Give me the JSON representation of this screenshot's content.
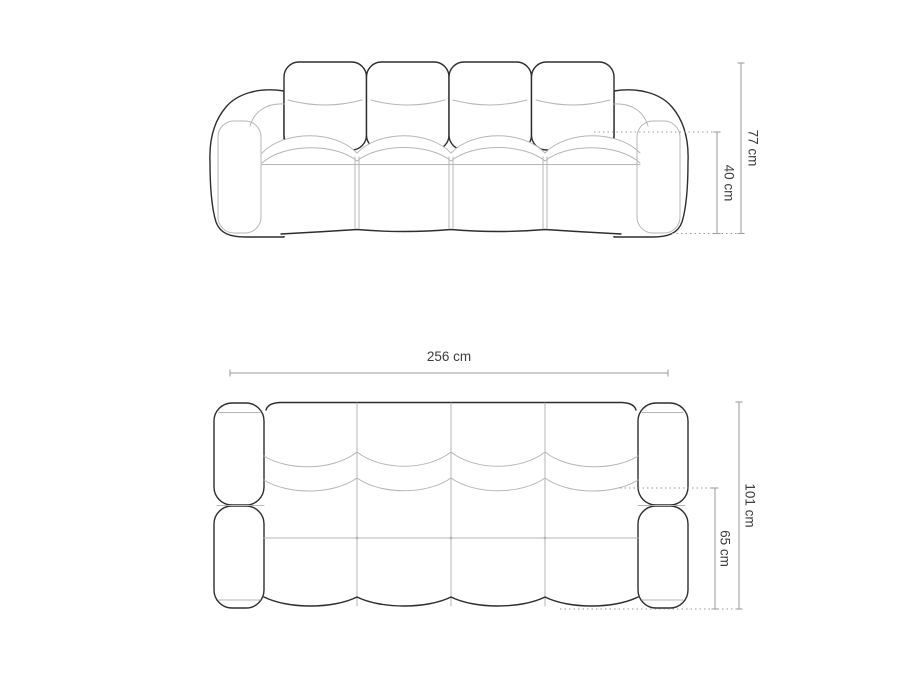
{
  "colors": {
    "background": "#ffffff",
    "outline": "#2e2e2e",
    "detail_line": "#b6b6b6",
    "dimension_line": "#9a9a9a",
    "label_text": "#3d3d3d"
  },
  "dimensions": {
    "front_total_height": "77 cm",
    "front_seat_height": "40 cm",
    "top_total_width": "256 cm",
    "top_total_depth": "101 cm",
    "top_seat_depth": "65 cm"
  }
}
